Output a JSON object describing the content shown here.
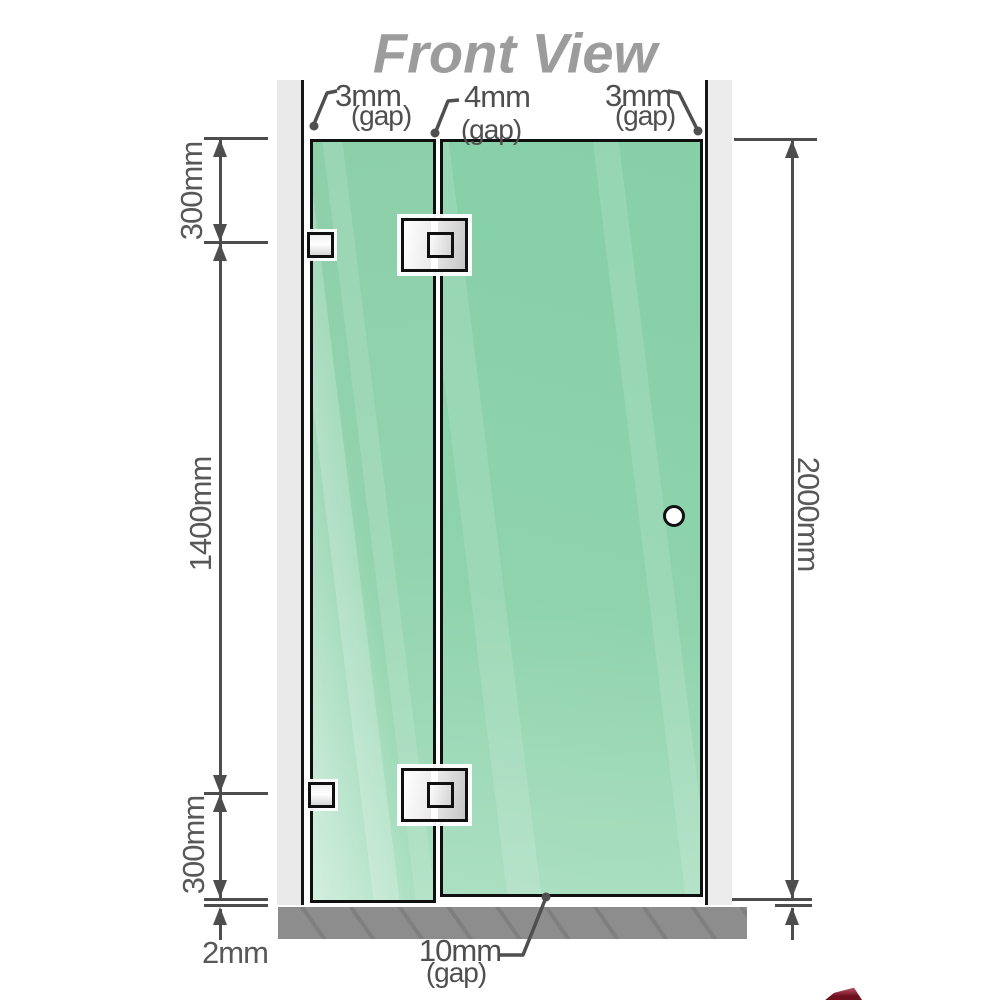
{
  "title": "Front View",
  "diagram": {
    "type": "shower-screen-front-elevation",
    "parts": [
      "left-wall",
      "fixed-glass-panel",
      "hinged-door-panel",
      "right-wall",
      "floor-base",
      "wall-bracket-top",
      "wall-bracket-bottom",
      "glass-hinge-top",
      "glass-hinge-bottom",
      "door-knob"
    ]
  },
  "dimensions": {
    "top_left": "300mm",
    "middle_left": "1400mm",
    "bottom_left": "300mm",
    "bottom_floor_gap": "2mm",
    "right_total": "2000mm"
  },
  "gaps": {
    "left": {
      "value": "3mm",
      "label": "(gap)"
    },
    "middle": {
      "value": "4mm",
      "label": "(gap)"
    },
    "right": {
      "value": "3mm",
      "label": "(gap)"
    },
    "bottom": {
      "value": "10mm",
      "label": "(gap)"
    }
  },
  "colors": {
    "glass_green": "#8ed3ac",
    "glass_highlight": "#b2e2c6",
    "wall_gray": "#eaeaea",
    "base_gray": "#8d8d8d",
    "outline_black": "#101010",
    "dimension_gray": "#4d4d4d",
    "title_gray": "#9c9c9c",
    "hardware_fill": "#e6e6e6",
    "corner_mark_red": "#6e0f20"
  }
}
